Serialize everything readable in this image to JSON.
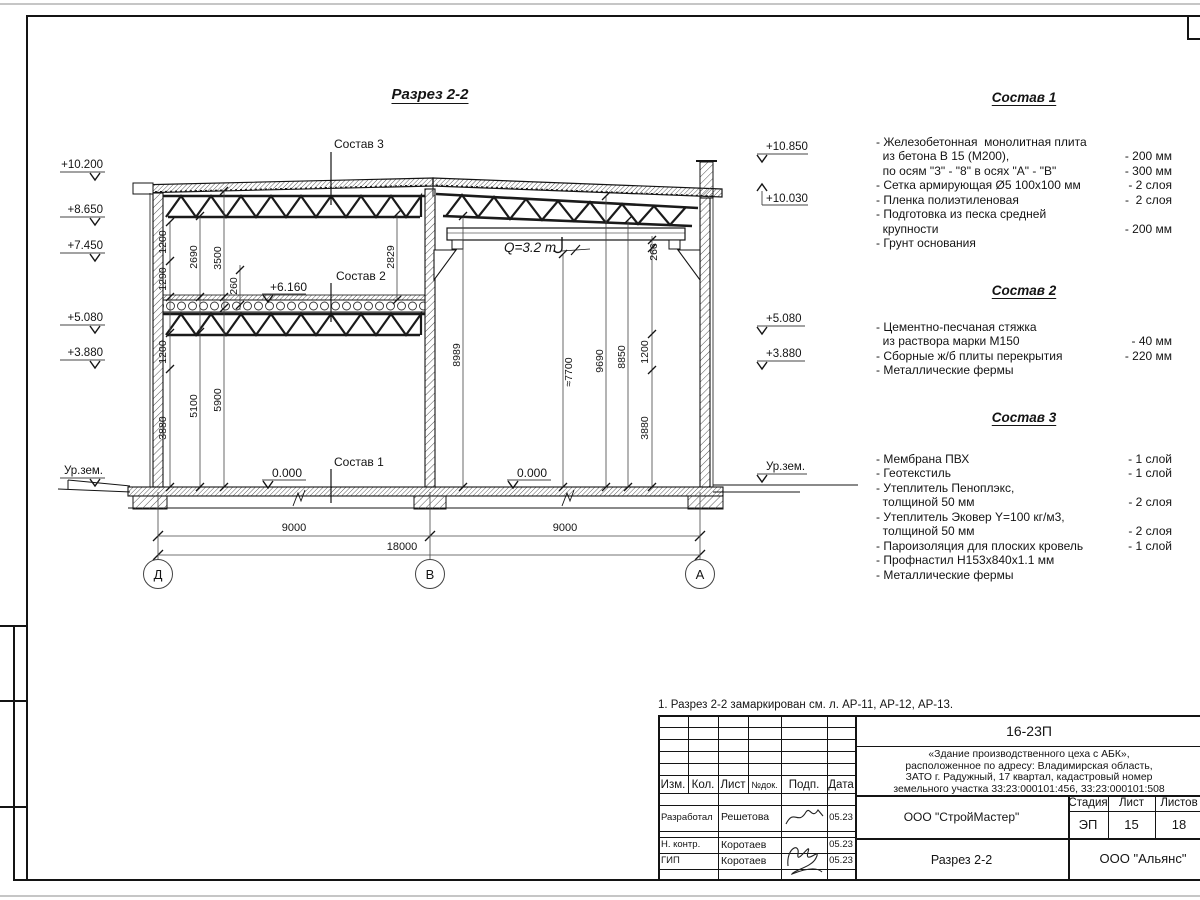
{
  "section": {
    "title": "Разрез 2-2",
    "elev_left": [
      "+10.200",
      "+8.650",
      "+7.450",
      "+5.080",
      "+3.880",
      "Ур.зем."
    ],
    "elev_right": [
      "+10.850",
      "+10.030",
      "+5.080",
      "+3.880",
      "Ур.зем."
    ],
    "labels": {
      "sostav3": "Состав 3",
      "sostav2": "Состав 2",
      "sostav1": "Состав 1",
      "lvl_6160": "+6.160",
      "zero_left": "0.000",
      "zero_right": "0.000",
      "crane": "Q=3.2 т"
    },
    "dims": {
      "lb_1200_top": "1200",
      "lb_1290": "1290",
      "lb_2690": "2690",
      "lb_3500": "3500",
      "lb_260": "260",
      "lb_2829": "2829",
      "lb_1200_low": "1200",
      "lb_3880": "3880",
      "lb_5100": "5100",
      "lb_5900": "5900",
      "rb_8989": "8989",
      "rb_7700": "≈7700",
      "rb_9690": "9690",
      "rb_8850": "8850",
      "rb_266": "266",
      "rb_1200": "1200",
      "rb_3880": "3880",
      "span_left": "9000",
      "span_right": "9000",
      "total": "18000"
    },
    "axes": [
      "Д",
      "В",
      "А"
    ]
  },
  "panels": {
    "s1": {
      "title": "Состав 1",
      "rows": [
        {
          "l": "- Железобетонная  монолитная плита",
          "r": ""
        },
        {
          "l": "  из бетона В 15 (М200),",
          "r": "- 200 мм"
        },
        {
          "l": "  по осям \"3\" - \"8\" в осях \"А\" - \"В\"",
          "r": "- 300 мм"
        },
        {
          "l": "- Сетка армирующая Ø5 100х100 мм",
          "r": "- 2 слоя"
        },
        {
          "l": "- Пленка полиэтиленовая",
          "r": "-  2 слоя"
        },
        {
          "l": "- Подготовка из песка средней",
          "r": ""
        },
        {
          "l": "  крупности",
          "r": "- 200 мм"
        },
        {
          "l": "- Грунт основания",
          "r": ""
        }
      ]
    },
    "s2": {
      "title": "Состав 2",
      "rows": [
        {
          "l": "- Цементно-песчаная стяжка",
          "r": ""
        },
        {
          "l": "  из раствора марки М150",
          "r": "- 40 мм"
        },
        {
          "l": "- Сборные ж/б плиты перекрытия",
          "r": "- 220 мм"
        },
        {
          "l": "- Металлические фермы",
          "r": ""
        }
      ]
    },
    "s3": {
      "title": "Состав 3",
      "rows": [
        {
          "l": "- Мембрана ПВХ",
          "r": "- 1 слой"
        },
        {
          "l": "- Геотекстиль",
          "r": "- 1 слой"
        },
        {
          "l": "- Утеплитель Пеноплэкс,",
          "r": ""
        },
        {
          "l": "  толщиной 50 мм",
          "r": "- 2 слоя"
        },
        {
          "l": "- Утеплитель Эковер Y=100 кг/м3,",
          "r": ""
        },
        {
          "l": "  толщиной 50 мм",
          "r": "- 2 слоя"
        },
        {
          "l": "- Пароизоляция для плоских кровель",
          "r": "- 1 слой"
        },
        {
          "l": "- Профнастил Н153х840х1.1 мм",
          "r": ""
        },
        {
          "l": "- Металлические фермы",
          "r": ""
        }
      ]
    }
  },
  "note": "1. Разрез 2-2 замаркирован см. л. АР-11, АР-12, АР-13.",
  "titleblock": {
    "doc_number": "16-23П",
    "project_lines": [
      "«Здание производственного цеха с АБК»,",
      "расположенное по адресу: Владимирская область,",
      "ЗАТО г. Радужный, 17 квартал, кадастровый номер",
      "земельного участка 33:23:000101:456, 33:23:000101:508"
    ],
    "cols": {
      "izm": "Изм.",
      "kol": "Кол.",
      "list": "Лист",
      "ndoc": "№док.",
      "podp": "Подп.",
      "data": "Дата"
    },
    "rows": [
      {
        "role": "Разработал",
        "name": "Решетова",
        "date": "05.23"
      },
      {
        "role": "Н. контр.",
        "name": "Коротаев",
        "date": "05.23"
      },
      {
        "role": "ГИП",
        "name": "Коротаев",
        "date": "05.23"
      }
    ],
    "org": "ООО \"СтройМастер\"",
    "stage_label": "Стадия",
    "sheet_label": "Лист",
    "sheets_label": "Листов",
    "stage": "ЭП",
    "sheet": "15",
    "sheets": "18",
    "drawing_name": "Разрез 2-2",
    "customer": "ООО \"Альянс\""
  }
}
